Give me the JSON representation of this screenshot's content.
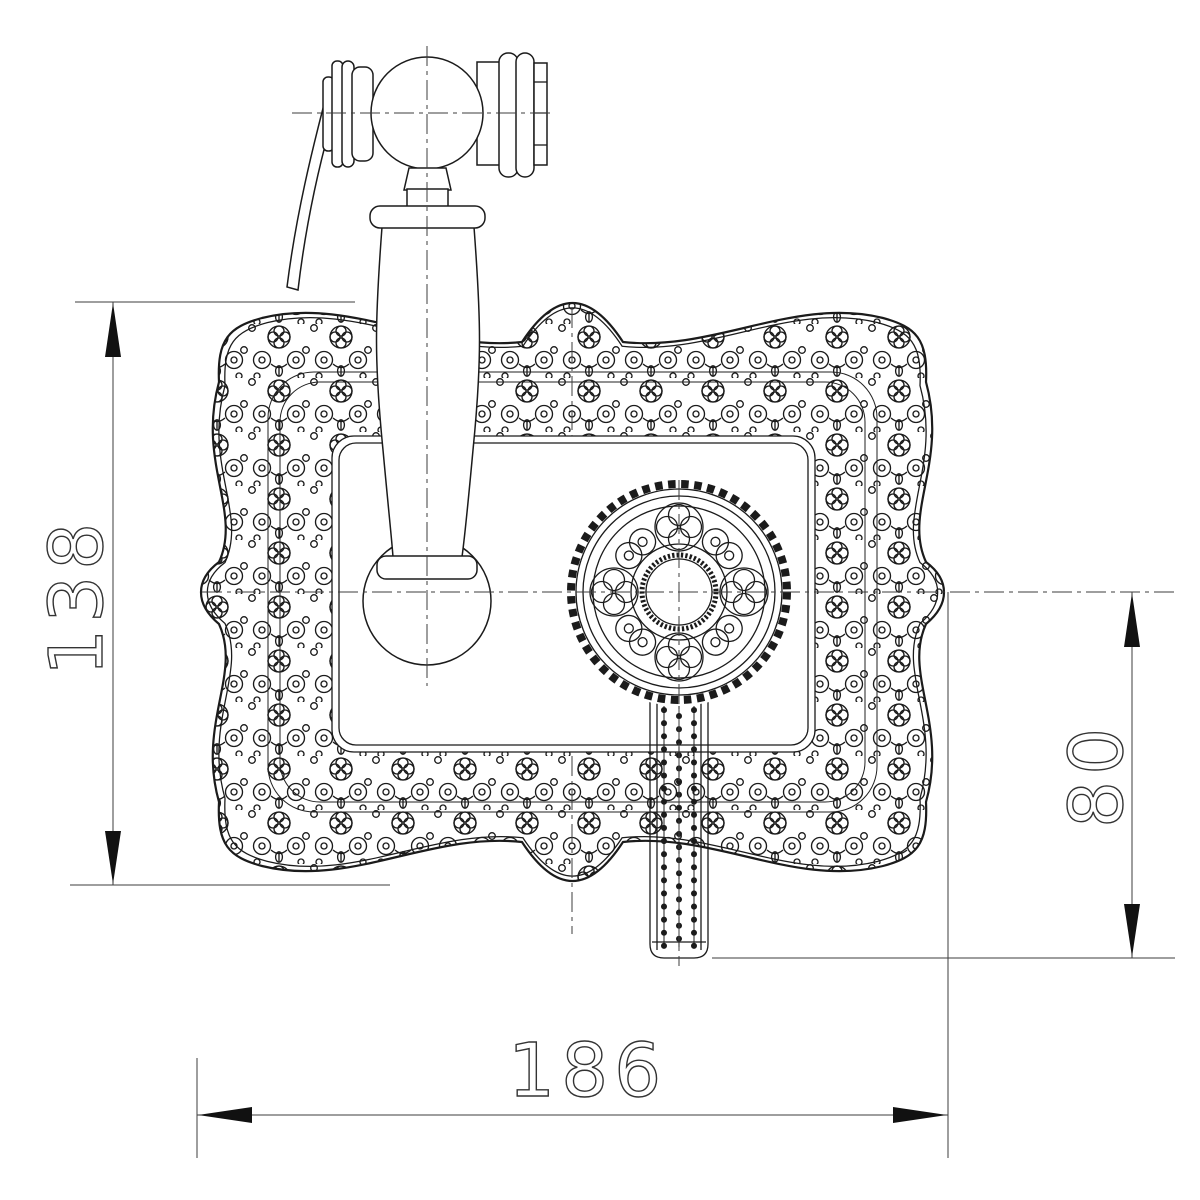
{
  "drawing": {
    "type_label": "technical-drawing",
    "dimension_height": {
      "value": "138",
      "orientation": "vertical-left"
    },
    "dimension_width": {
      "value": "186",
      "orientation": "horizontal-bottom"
    },
    "dimension_handle": {
      "value": "80",
      "orientation": "vertical-right"
    },
    "colors": {
      "line": "#1b1b1b",
      "dimension": "#3c3c3c",
      "arrow": "#111111",
      "background": "#ffffff"
    }
  }
}
